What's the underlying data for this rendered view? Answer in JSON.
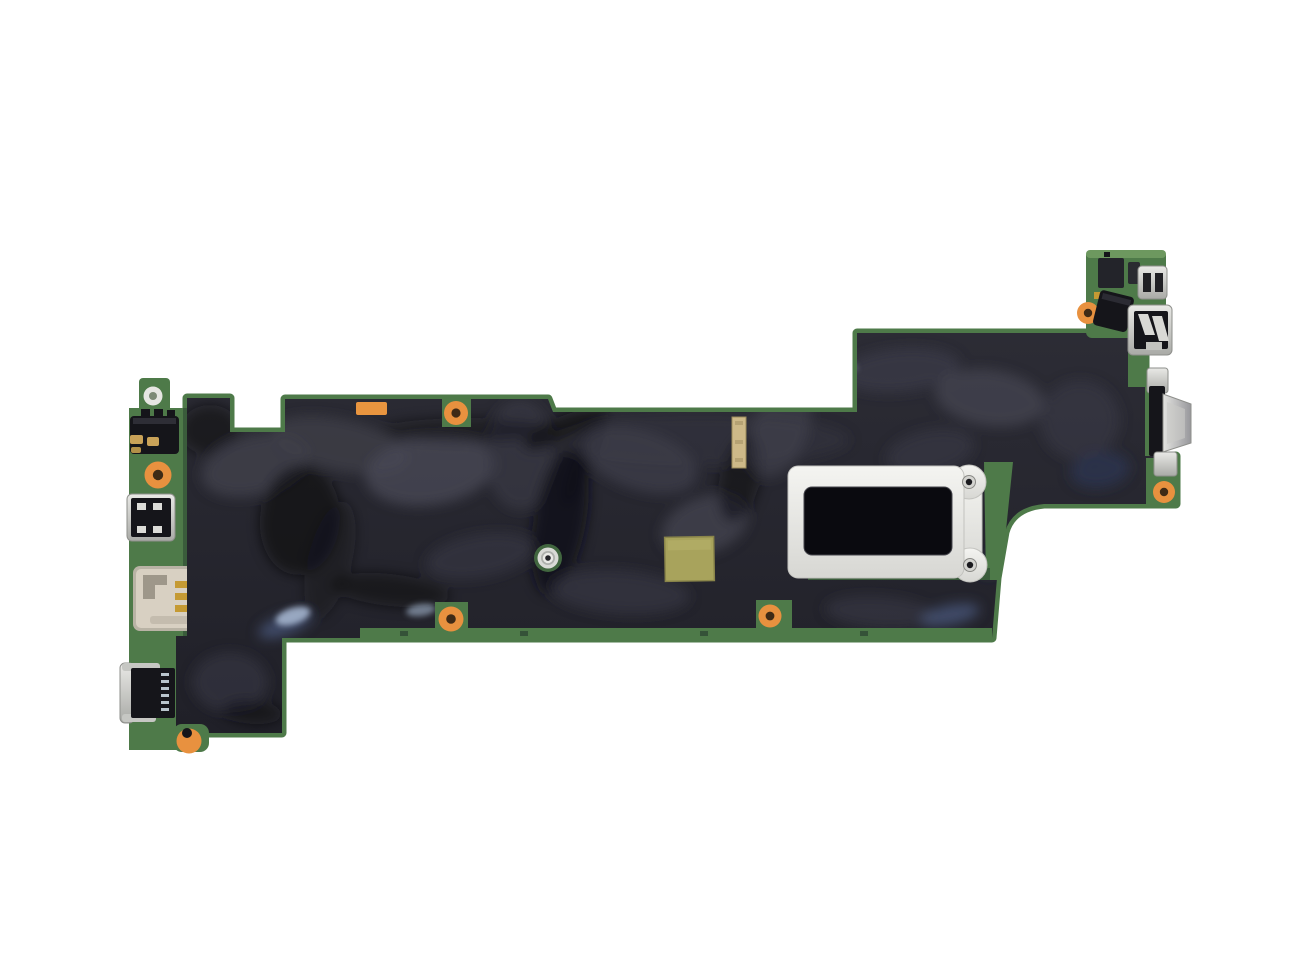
{
  "scene": {
    "type": "product-photo",
    "subject": "laptop motherboard viewed from above on a plain white background",
    "notes": "bare PCB wrapped in dark wrinkled mylar insulation film, I/O ports on left and right edges, silver CPU retention bracket right of center"
  },
  "colors": {
    "bg": "#ffffff",
    "pcb": "#4e7a49",
    "pcbDark": "#3a5c3b",
    "pcbLight": "#6d985f",
    "film": "#26262e",
    "filmHi": "#3d3d49",
    "filmHi2": "#4b4b59",
    "filmLo": "#111116",
    "filmBlue": "#2c3350",
    "filmBlue2": "#4d5d82",
    "glint": "#a9bad4",
    "metal": "#c7c8c4",
    "metalLight": "#ebebe8",
    "metalDark": "#8e8f8b",
    "bracket": "#ececea",
    "orange": "#e8913f",
    "orangeHole": "#3f2a16",
    "gold": "#cdb988",
    "contactGold": "#c59a33",
    "olive": "#a8a35c",
    "sticker": "#e9953f",
    "blackPart": "#15151a",
    "simBody": "#d8d0c2"
  },
  "board": {
    "sections": [
      "left-io-column",
      "main-body",
      "top-right-io-island",
      "bottom-left-block"
    ],
    "left_io_parts": [
      "mount-hole-silver",
      "audio-jack",
      "mount-hole-orange",
      "usb-port",
      "sim-card-slot",
      "dock-connector",
      "mount-hole-orange"
    ],
    "right_io_parts": [
      "mini-connector",
      "usb-port",
      "vga-connector"
    ],
    "center_parts": [
      "cpu-retention-bracket",
      "thermal-pad",
      "metal-standoff",
      "gold-strip",
      "orange-sticker"
    ],
    "orange_screw_hole_count": 7,
    "metal_screw_hole_count": 3
  }
}
